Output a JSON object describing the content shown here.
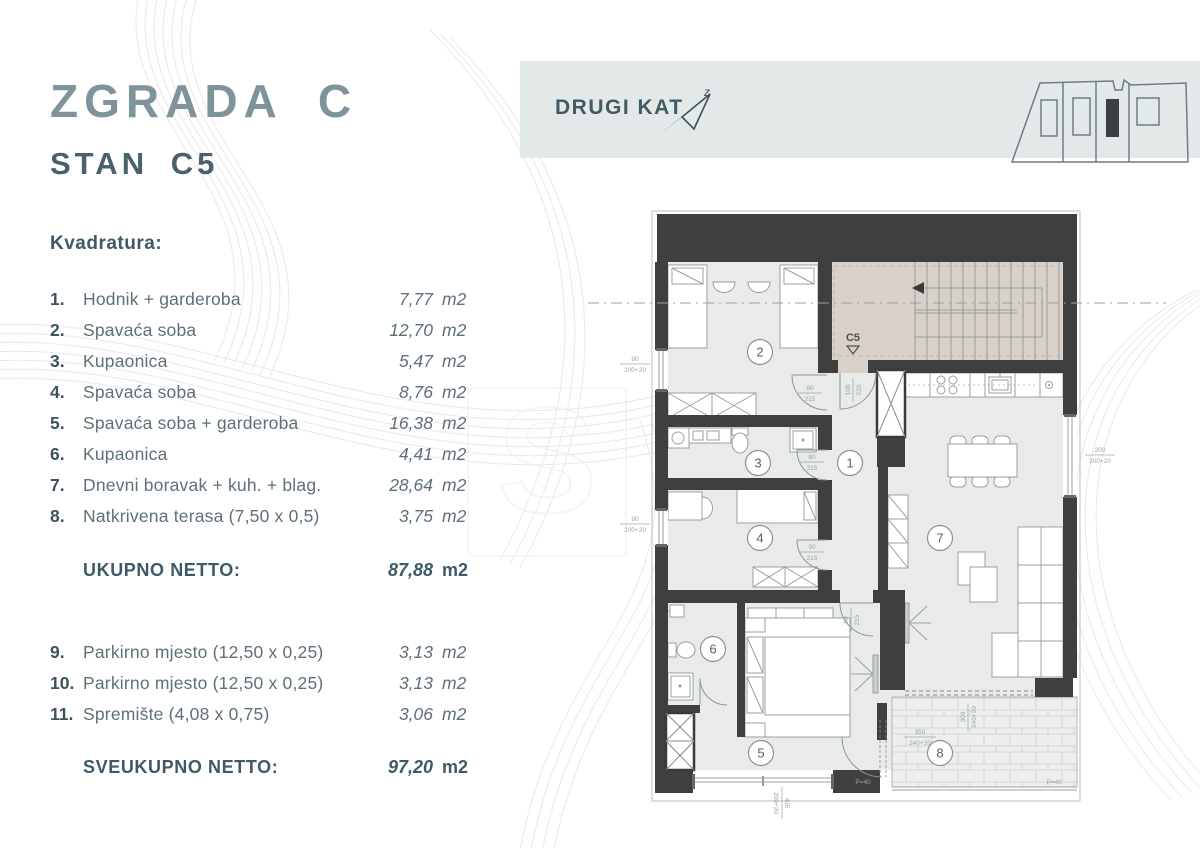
{
  "title": {
    "building": "ZGRADA C",
    "unit": "STAN C5"
  },
  "header": {
    "floor_label": "DRUGI KAT",
    "north_mark": "z"
  },
  "areas": {
    "heading": "Kvadratura:",
    "items": [
      {
        "num": "1.",
        "label": "Hodnik + garderoba",
        "value": "7,77",
        "unit": "m2"
      },
      {
        "num": "2.",
        "label": "Spavaća soba",
        "value": "12,70",
        "unit": "m2"
      },
      {
        "num": "3.",
        "label": "Kupaonica",
        "value": "5,47",
        "unit": "m2"
      },
      {
        "num": "4.",
        "label": "Spavaća soba",
        "value": "8,76",
        "unit": "m2"
      },
      {
        "num": "5.",
        "label": "Spavaća soba + garderoba",
        "value": "16,38",
        "unit": "m2"
      },
      {
        "num": "6.",
        "label": "Kupaonica",
        "value": "4,41",
        "unit": "m2"
      },
      {
        "num": "7.",
        "label": "Dnevni boravak + kuh. + blag.",
        "value": "28,64",
        "unit": "m2"
      },
      {
        "num": "8.",
        "label": "Natkrivena terasa (7,50 x 0,5)",
        "value": "3,75",
        "unit": "m2"
      }
    ],
    "subtotal": {
      "label": "UKUPNO NETTO:",
      "value": "87,88",
      "unit": "m2"
    },
    "extras": [
      {
        "num": "9.",
        "label": "Parkirno mjesto (12,50 x 0,25)",
        "value": "3,13",
        "unit": "m2"
      },
      {
        "num": "10.",
        "label": "Parkirno mjesto (12,50 x 0,25)",
        "value": "3,13",
        "unit": "m2"
      },
      {
        "num": "11.",
        "label": "Spremište (4,08 x 0,75)",
        "value": "3,06",
        "unit": "m2"
      }
    ],
    "total": {
      "label": "SVEUKUPNO NETTO:",
      "value": "97,20",
      "unit": "m2"
    }
  },
  "plan": {
    "unit_marker": "C5",
    "rooms": [
      "1",
      "2",
      "3",
      "4",
      "5",
      "6",
      "7",
      "8"
    ],
    "dims": {
      "entry_door": {
        "w": "100",
        "h": "220"
      },
      "room2_door": {
        "w": "90",
        "h": "215"
      },
      "bath3_door": {
        "w": "80",
        "h": "215"
      },
      "room4_door": {
        "w": "90",
        "h": "215"
      },
      "room5_door": {
        "w": "90",
        "h": "215"
      },
      "terrace_door": {
        "w": "150",
        "h": "240+20"
      },
      "terrace_side": {
        "w": "300",
        "h": "240+20"
      },
      "window_right": {
        "w": "200",
        "h": "200+20"
      },
      "window_bottom": {
        "w": "435",
        "h": "200+20"
      },
      "window_left_upper": {
        "w": "90",
        "h": "200+20"
      },
      "window_left_lower": {
        "w": "90",
        "h": "200+20"
      },
      "parapet_left": "P=40",
      "parapet_right": "P=40"
    }
  },
  "colors": {
    "accent_dark": "#3e5a66",
    "accent_gray": "#7e939b",
    "band": "#e3e9e8",
    "wall": "#3f3f3f",
    "stair": "#d8d1c9",
    "floor": "#e8ebe8"
  }
}
